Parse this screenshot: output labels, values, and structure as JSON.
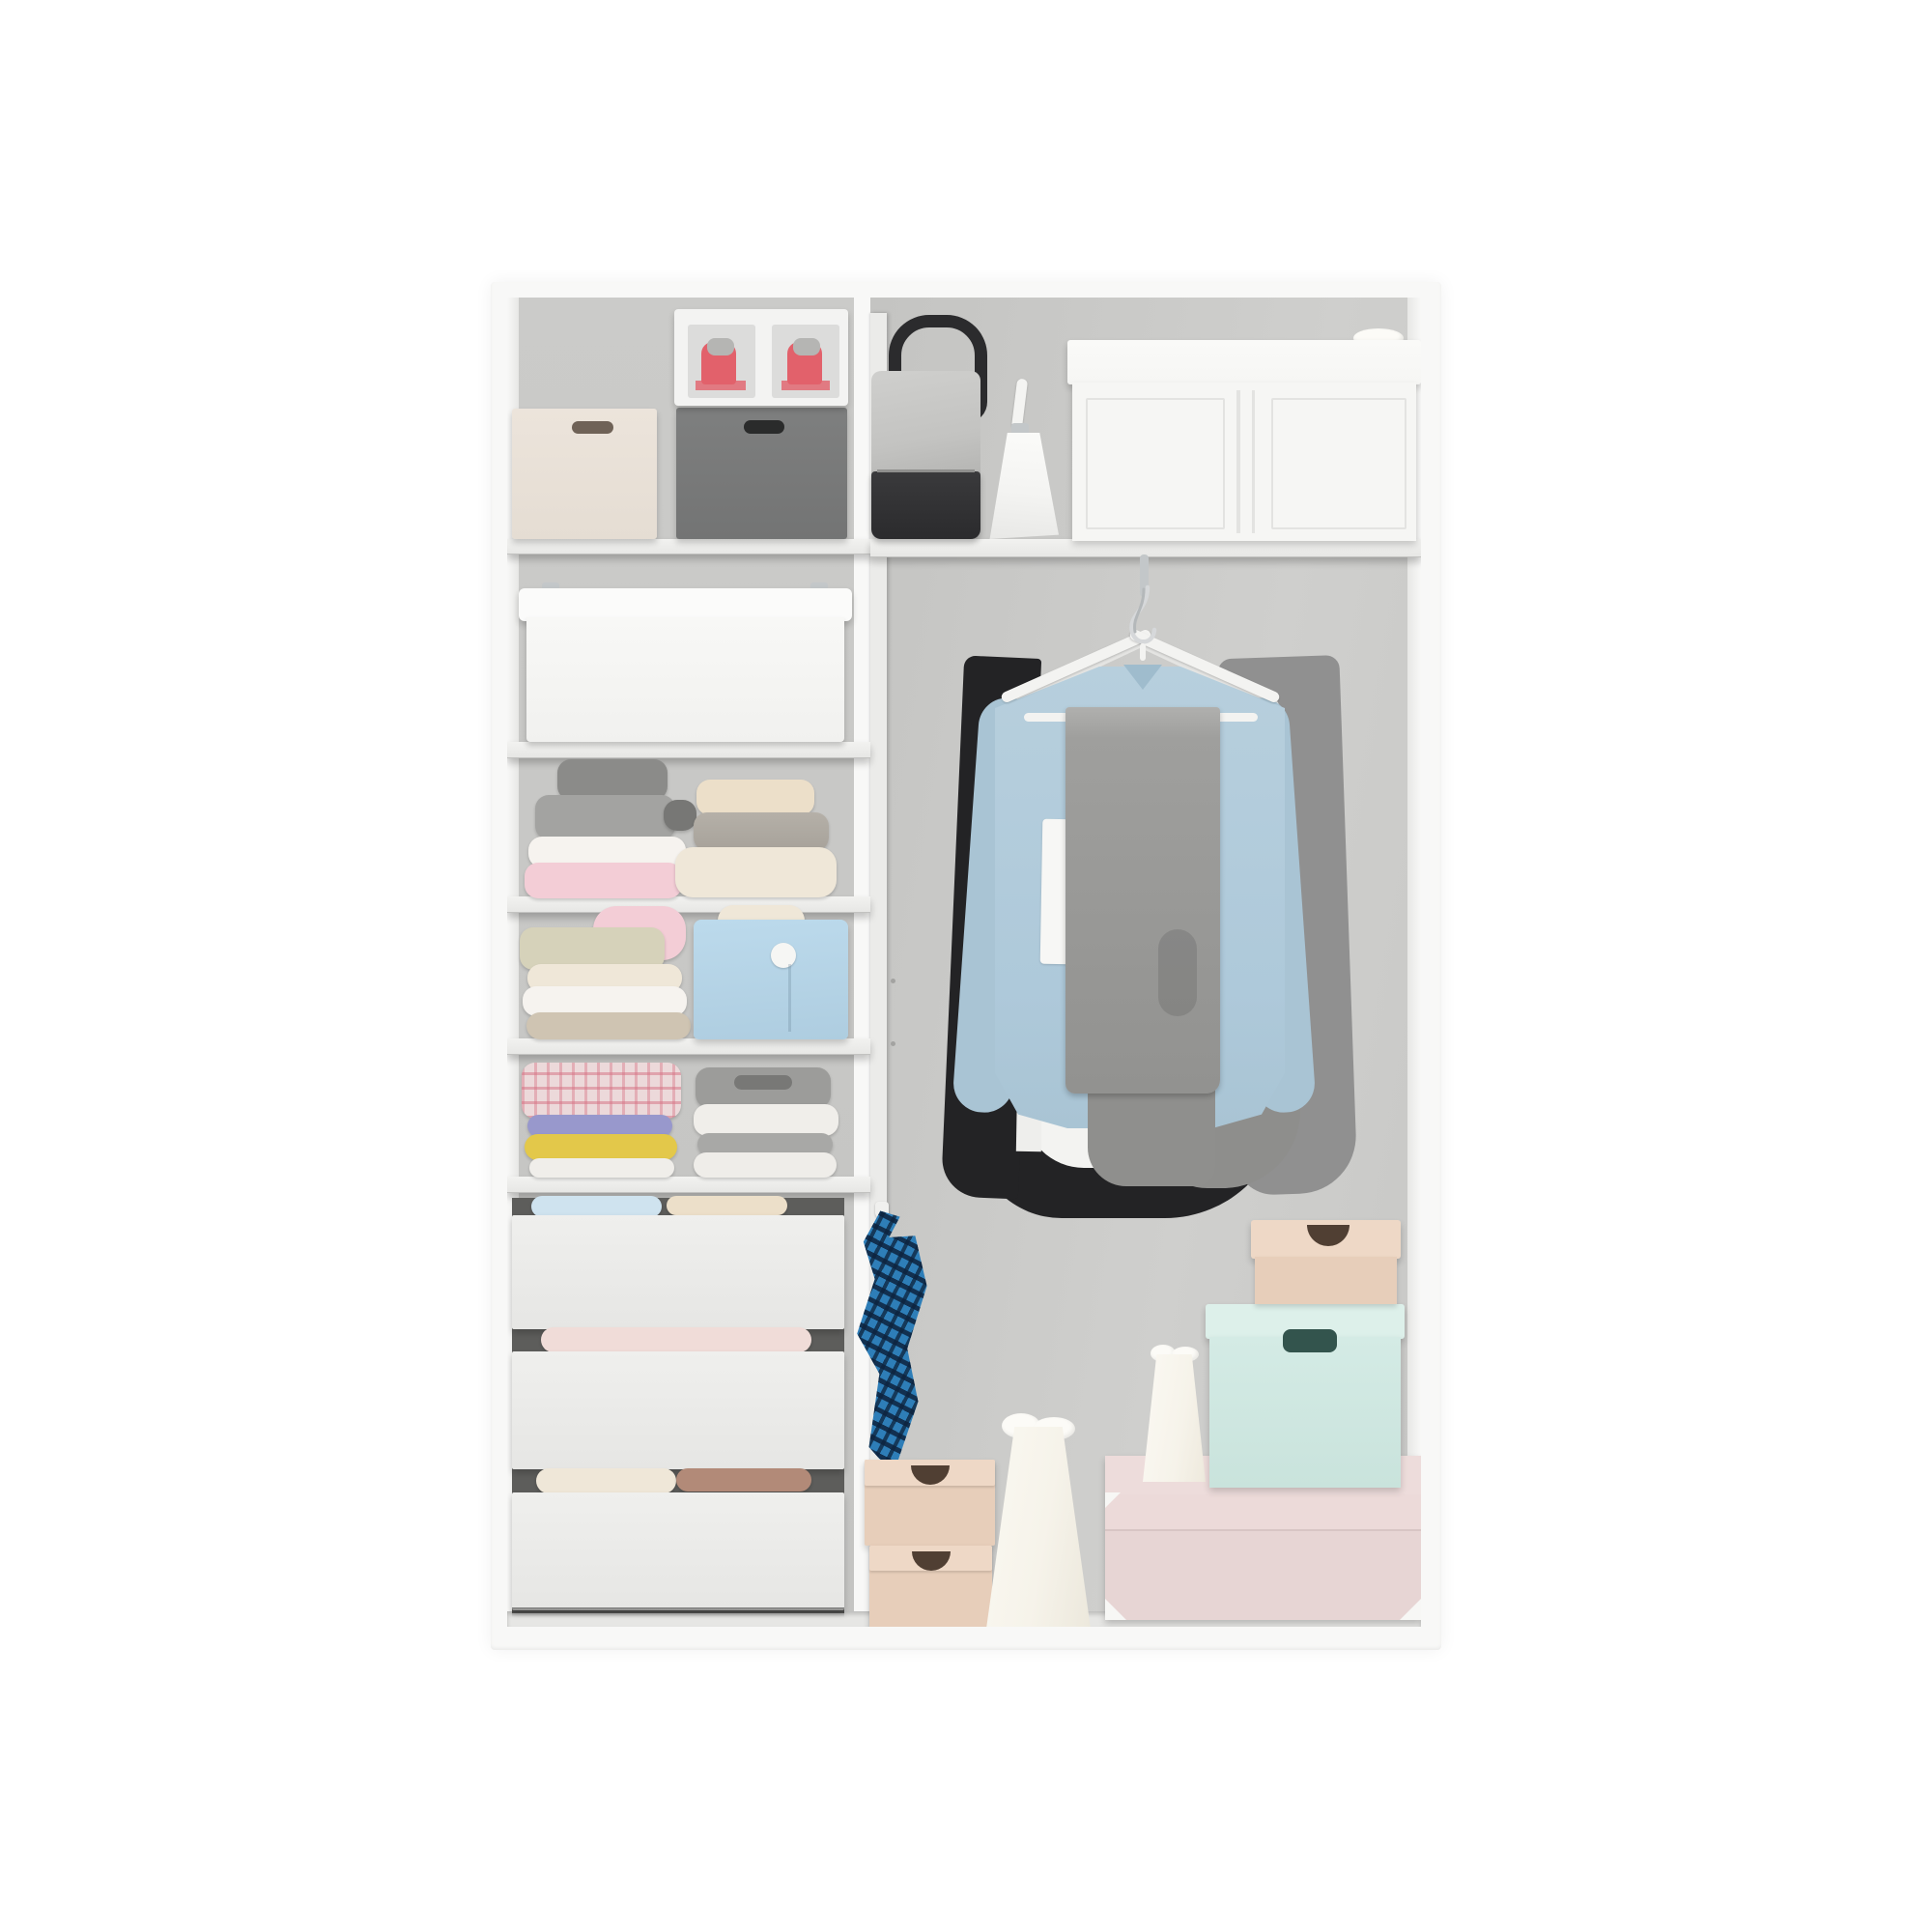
{
  "scene": {
    "type": "product-photo",
    "description": "Open white two-column wardrobe closet organizer shown from the front, filled with storage boxes, folded clothes, drawers and hanging garments on a plain white background",
    "left_column": {
      "sections": [
        {
          "name": "top-shelf",
          "items": [
            "cream storage box with handle slot",
            "clear shoe box with red sneakers",
            "dark gray storage box with handle slot"
          ]
        },
        {
          "name": "bin-shelf",
          "items": [
            "white storage bin with clip handles"
          ]
        },
        {
          "name": "sweater-shelf",
          "items": [
            "stack: dark gray, gray, white, pink sweaters",
            "stack: cream, gray, cream knit sweaters"
          ]
        },
        {
          "name": "linen-shelf",
          "items": [
            "pile of folded linens with pink rolled towel and sage knit",
            "light blue fabric basket with button",
            "cream chunky knit"
          ]
        },
        {
          "name": "shirt-shelf",
          "items": [
            "stack: pink plaid, purple, yellow, white folded shirts",
            "stack: gray and white folded shirts"
          ]
        },
        {
          "name": "drawer-stack",
          "items": [
            "white drawer 1",
            "white drawer 2",
            "white drawer 3",
            "folded clothes tucked between drawers"
          ]
        }
      ]
    },
    "right_column": {
      "sections": [
        {
          "name": "top-shelf",
          "items": [
            "black leather handbag with gray fabric",
            "small white handbag",
            "large white storage box with lid"
          ]
        },
        {
          "name": "hanging-area",
          "items": [
            "chrome rod hook",
            "two white hangers",
            "light blue shirt",
            "gray trousers folded over hanger bar",
            "black and gray garments behind"
          ]
        },
        {
          "name": "floor-area",
          "items": [
            "blue plaid cloth on wall hook",
            "two stacked beige shoe boxes",
            "tall cream paper bag with tissue",
            "small cream paper bag",
            "mint storage box with dark handle",
            "small beige lidded box",
            "large blush pink storage box with corner protectors"
          ]
        }
      ]
    }
  },
  "labels": {
    "wardrobe": "White wardrobe closet organizer",
    "cream_box": "Cream storage box",
    "gray_box": "Dark gray storage box",
    "shoe_box": "Clear shoe box with red sneakers",
    "white_bin": "White storage bin with clip handles",
    "sweater_stack_left": "Stack of folded sweaters (gray, white, pink)",
    "sweater_stack_right": "Stack of folded sweaters (cream, gray)",
    "linen_pile": "Pile of folded linens with pink roll",
    "blue_basket": "Light blue fabric basket",
    "plaid_stack": "Stack with plaid and colorful folded shirts",
    "shirt_stack": "Stack of gray and white folded shirts",
    "drawer_1": "White drawer 1",
    "drawer_2": "White drawer 2",
    "drawer_3": "White drawer 3",
    "black_handbag": "Black handbag with gray fabric",
    "white_handbag": "Small white handbag",
    "big_white_box": "Large white storage box",
    "rod_hook": "Chrome rod hook",
    "hanger": "White clothes hanger",
    "blue_shirt": "Light blue shirt on hanger",
    "gray_pants": "Gray trousers folded over hanger",
    "plaid_cloth": "Blue plaid cloth on hook",
    "beige_shoe_boxes": "Stacked beige shoe boxes",
    "paper_bag_tall": "Tall cream paper bag",
    "paper_bag_small": "Small cream paper bag",
    "mint_box": "Mint storage box",
    "beige_small_box": "Small beige lidded box",
    "pink_box": "Blush pink storage box"
  },
  "palette": {
    "page-bg": "#ffffff",
    "frame": "#f8f8f7",
    "shelf-face": "#e7e7e5",
    "shelf-hi": "#f2f2f0",
    "shelf-edge": "#c2c2c0",
    "divider": "#ebebe9",
    "floor": "#e6e6e4",
    "wall-left": "#c4c4c2",
    "wall-left-hi": "#cbcbc9",
    "wall-right": "#c8c8c6",
    "wall-right-hi": "#cfcfcd",
    "box-cream": "#ece4db",
    "box-cream-handle": "#6f6257",
    "box-darkgray": "#7e7f7f",
    "box-darkgray-handle": "#2a2b2b",
    "shoebox-frame": "#f3f3f2",
    "shoebox-window": "#dcdcdb",
    "shoe-red": "#e2616b",
    "shoe-gray": "#b5b5b3",
    "bin-white": "#fbfbfa",
    "bin-body": "#f8f8f6",
    "chrome": "#c3c7c9",
    "sweater-pink": "#f3cdd6",
    "sweater-white": "#f6f3ef",
    "sweater-gray": "#a3a3a1",
    "sweater-darkgray": "#8b8b89",
    "sweater-cream": "#ecdfc9",
    "sweater-taupe": "#cfc4b2",
    "knit-cream": "#efe7d8",
    "sage": "#d6d2ba",
    "basket-blue": "#bcdaec",
    "plaid-pink-base": "#ecd9da",
    "fold-purple": "#9898cc",
    "fold-yellow": "#e3c84a",
    "fold-white": "#f0eeea",
    "fold-gray": "#9c9c9a",
    "fold-blue": "#cfe3ef",
    "fold-blush": "#f0dcd8",
    "fold-brown": "#b28a78",
    "drawer-face": "#efefed",
    "drawer-face-lo": "#e6e6e4",
    "drawer-back": "#5d5d5b",
    "shirt-blue": "#b7cfdd",
    "shirt-blue-lo": "#a9c4d4",
    "collar-blue": "#9fbccd",
    "pants-gray": "#9f9f9d",
    "pants-gray-lo": "#929290",
    "garment-black": "#232325",
    "garment-gray": "#909090",
    "hanger-white": "#f3f3f1",
    "hanger-white2": "#e4e4e2",
    "bag-black": "#2b2b2d",
    "bag-fabric": "#c3c3c1",
    "bag-white": "#f4f4f2",
    "bigbox-white": "#f6f6f4",
    "bigbox-seam": "#e3e3e1",
    "plaid-blue": "#2e7eb8",
    "shoebox-beige": "#e7ceba",
    "shoebox-beige-lid": "#eed8c6",
    "shoebox-notch": "#503f33",
    "paperbag": "#f6f3ea",
    "tissue": "#fcfbf7",
    "mint-box": "#d4ebe5",
    "mint-box-lid": "#ddf0ea",
    "mint-handle": "#33544d",
    "pink-box": "#e7d5d4",
    "pink-box-lid": "#eddcdb",
    "corner-metal": "#f7f7f5"
  }
}
